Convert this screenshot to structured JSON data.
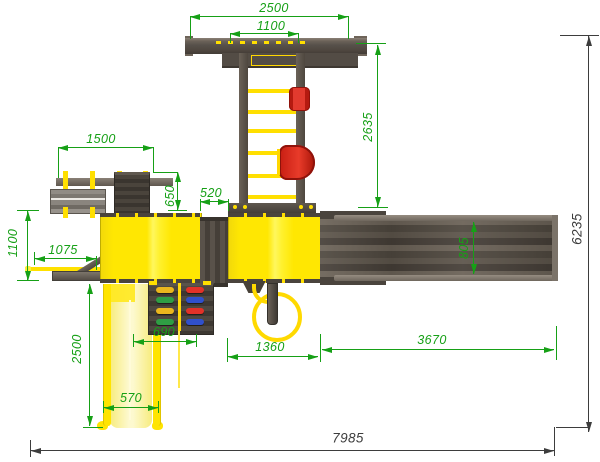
{
  "dimensions": {
    "top_width": "2500",
    "top_inner_width": "1100",
    "swing_depth": "2635",
    "bench_width": "1500",
    "bench_to_platform": "650",
    "bridge_width": "520",
    "left_offset": "1100",
    "ramp_length": "1075",
    "slide_length": "2500",
    "climbing_wall_width": "690",
    "slide_width": "570",
    "pole_offset": "1360",
    "walkway_length": "3670",
    "walkway_width": "805",
    "overall_width": "7985",
    "overall_depth": "6235"
  },
  "colors": {
    "dimension_green": "#16A016",
    "dimension_dark": "#3d3d3d",
    "structure_yellow": "#FFE702",
    "wood_dark": "#57504A",
    "seat_red": "#D7281C"
  }
}
